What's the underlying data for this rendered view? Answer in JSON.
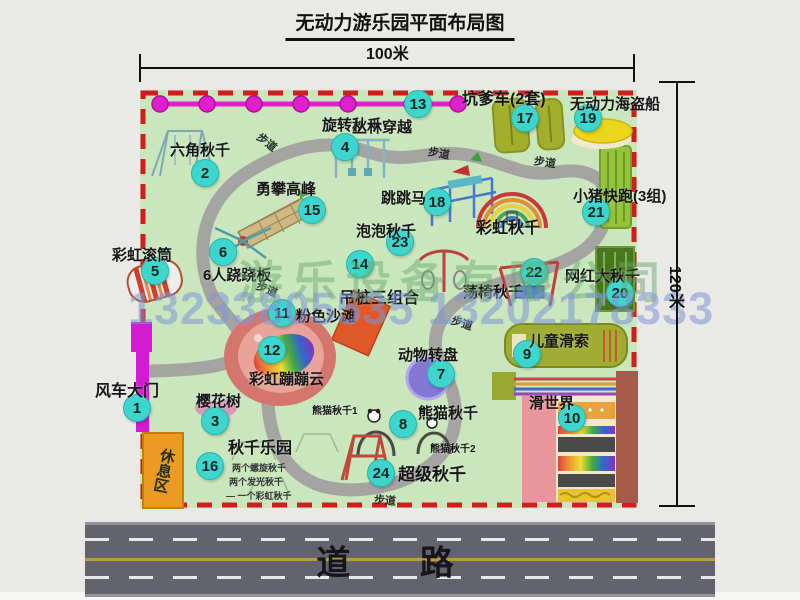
{
  "title": "无动力游乐园平面布局图",
  "dimensions": {
    "width_label": "100米",
    "height_label": "120米"
  },
  "road": {
    "label": "道  路"
  },
  "watermark": {
    "company": "游乐设备有限公司",
    "phone": "13233805535 13202178333"
  },
  "rest_area": {
    "label": "休息区"
  },
  "colors": {
    "map_green": "#c9e6bd",
    "border_red": "#d41c1c",
    "badge_cyan": "#3ed6cc",
    "chain_magenta": "#e020cc",
    "gate_magenta": "#d31bd3",
    "road_gray": "#63636d"
  },
  "attractions": [
    {
      "num": "1",
      "name": "风车大门",
      "bx": 137,
      "by": 408,
      "lx": 95,
      "ly": 377,
      "fs": 16
    },
    {
      "num": "2",
      "name": "六角秋千",
      "bx": 205,
      "by": 173,
      "lx": 170,
      "ly": 139,
      "fs": 15
    },
    {
      "num": "3",
      "name": "樱花树",
      "bx": 215,
      "by": 421,
      "lx": 196,
      "ly": 390,
      "fs": 15
    },
    {
      "num": "4",
      "name": "旋转秋千",
      "bx": 345,
      "by": 147,
      "lx": 322,
      "ly": 114,
      "fs": 15
    },
    {
      "num": "5",
      "name": "彩虹滚筒",
      "bx": 155,
      "by": 271,
      "lx": 112,
      "ly": 244,
      "fs": 15
    },
    {
      "num": "6",
      "name": "6人跷跷板",
      "bx": 223,
      "by": 252,
      "lx": 203,
      "ly": 264,
      "fs": 15
    },
    {
      "num": "7",
      "name": "动物转盘",
      "bx": 441,
      "by": 374,
      "lx": 398,
      "ly": 344,
      "fs": 15
    },
    {
      "num": "8",
      "name": "熊猫秋千",
      "bx": 403,
      "by": 424,
      "lx": 418,
      "ly": 402,
      "fs": 15
    },
    {
      "num": "9",
      "name": "儿童滑索",
      "bx": 527,
      "by": 354,
      "lx": 529,
      "ly": 330,
      "fs": 15
    },
    {
      "num": "10",
      "name": "滑世界",
      "bx": 572,
      "by": 418,
      "lx": 529,
      "ly": 392,
      "fs": 15
    },
    {
      "num": "11",
      "name": "粉色沙滩",
      "bx": 282,
      "by": 313,
      "lx": 296,
      "ly": 305,
      "fs": 15
    },
    {
      "num": "12",
      "name": "彩虹蹦蹦云",
      "bx": 272,
      "by": 350,
      "lx": 249,
      "ly": 368,
      "fs": 15
    },
    {
      "num": "13",
      "name": "丛林穿越",
      "bx": 418,
      "by": 104,
      "lx": 352,
      "ly": 116,
      "fs": 15
    },
    {
      "num": "14",
      "name": "吊桩三组合",
      "bx": 360,
      "by": 264,
      "lx": 339,
      "ly": 284,
      "fs": 16
    },
    {
      "num": "15",
      "name": "勇攀高峰",
      "bx": 312,
      "by": 210,
      "lx": 256,
      "ly": 178,
      "fs": 15
    },
    {
      "num": "16",
      "name": "秋千乐园",
      "bx": 210,
      "by": 466,
      "lx": 228,
      "ly": 434,
      "fs": 16
    },
    {
      "num": "17",
      "name": "坑爹车(2套)",
      "bx": 525,
      "by": 118,
      "lx": 462,
      "ly": 85,
      "fs": 16
    },
    {
      "num": "18",
      "name": "跳跳马",
      "bx": 437,
      "by": 202,
      "lx": 381,
      "ly": 187,
      "fs": 15
    },
    {
      "num": "19",
      "name": "无动力海盗船",
      "bx": 588,
      "by": 118,
      "lx": 570,
      "ly": 93,
      "fs": 15
    },
    {
      "num": "20",
      "name": "网红大秋千",
      "bx": 620,
      "by": 293,
      "lx": 565,
      "ly": 265,
      "fs": 15
    },
    {
      "num": "21",
      "name": "小猪快跑(3组)",
      "bx": 596,
      "by": 212,
      "lx": 573,
      "ly": 185,
      "fs": 15
    },
    {
      "num": "22",
      "name": "荡椅秋千",
      "bx": 534,
      "by": 272,
      "lx": 463,
      "ly": 281,
      "fs": 15
    },
    {
      "num": "23",
      "name": "泡泡秋千",
      "bx": 400,
      "by": 242,
      "lx": 356,
      "ly": 220,
      "fs": 15
    },
    {
      "num": "24",
      "name": "超级秋千",
      "bx": 381,
      "by": 473,
      "lx": 398,
      "ly": 460,
      "fs": 17
    }
  ],
  "extra_labels": [
    {
      "text": "彩虹秋千",
      "x": 476,
      "y": 214,
      "fs": 16
    },
    {
      "text": "熊猫秋千1",
      "x": 312,
      "y": 402,
      "fs": 10
    },
    {
      "text": "熊猫秋千2",
      "x": 430,
      "y": 440,
      "fs": 10
    }
  ],
  "swing_park_notes": [
    "两个螺旋秋千",
    "两个发光秋千",
    "一个彩虹秋千"
  ],
  "path_labels": {
    "text": "步道",
    "positions": [
      {
        "x": 256,
        "y": 281,
        "r": 22
      },
      {
        "x": 256,
        "y": 134,
        "r": 38
      },
      {
        "x": 428,
        "y": 145,
        "r": 10
      },
      {
        "x": 534,
        "y": 154,
        "r": 8
      },
      {
        "x": 451,
        "y": 315,
        "r": 18
      },
      {
        "x": 374,
        "y": 492,
        "r": 5
      }
    ]
  }
}
